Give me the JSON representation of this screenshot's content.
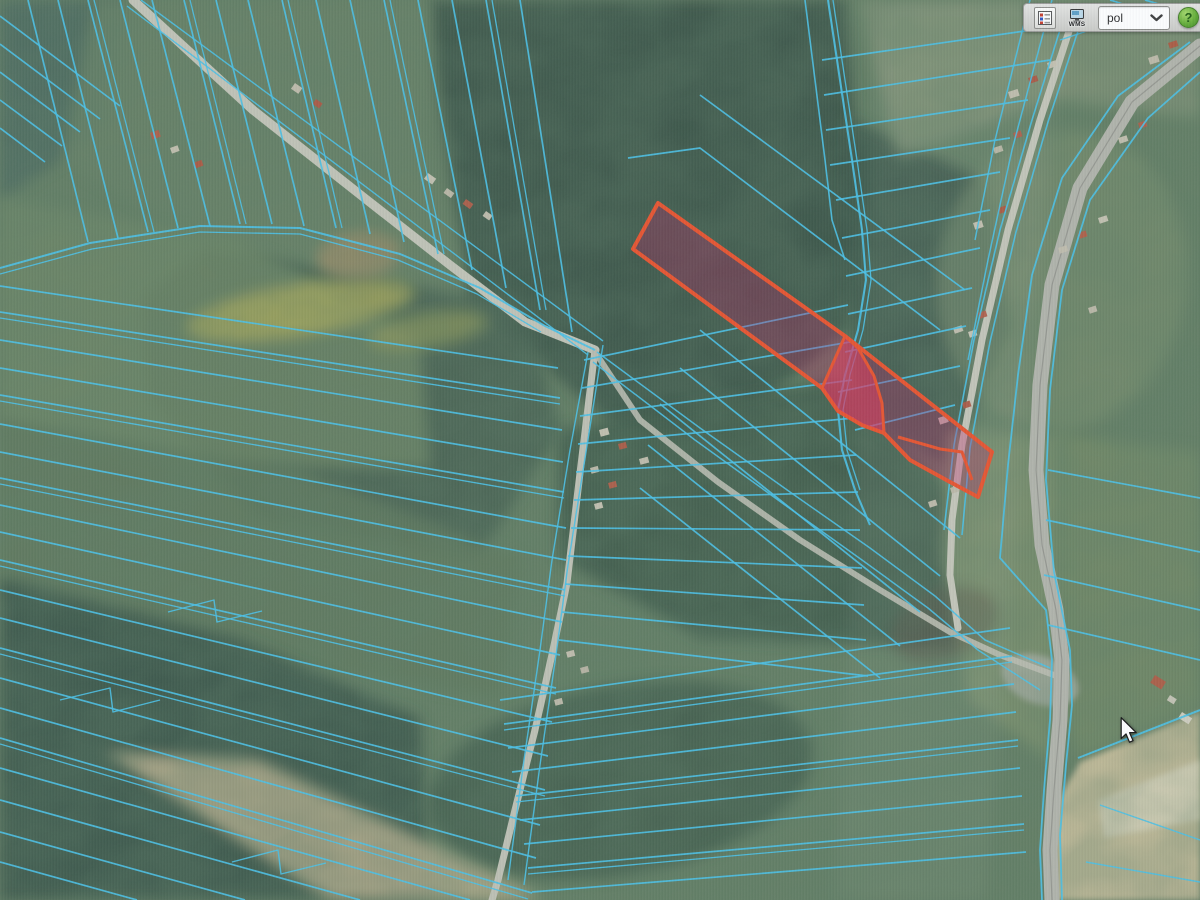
{
  "app": {
    "title": "gis-parcel-map-viewer"
  },
  "toolbar": {
    "wms_label": "WMS",
    "language_value": "pol",
    "help_label": "?",
    "legend_colors": [
      "#c43a2a",
      "#2a52c4"
    ]
  },
  "cursor": {
    "x": 1120,
    "y": 717
  },
  "map": {
    "colors": {
      "parcel": "#3fc4f0",
      "road": "#c5c6b8",
      "selection_stroke": "#f64b22",
      "selection_fill": "rgba(210,10,95,0.30)",
      "selection_bright_fill": "rgba(255,40,85,0.52)"
    },
    "patches": [
      {
        "p": "430,0 845,0 862,210 848,330 760,402 618,430 468,298 428,130",
        "f": "#2d483a",
        "o": 0.92
      },
      {
        "p": "205,248 520,290 560,430 478,558 258,518 148,398 142,298",
        "f": "#3a5744",
        "o": 0.85
      },
      {
        "p": "0,0 130,0 92,140 0,200",
        "f": "#416158",
        "o": 0.8
      },
      {
        "p": "95,0 428,0 468,298 205,240 62,160",
        "f": "#647e5e",
        "o": 0.85
      },
      {
        "p": "0,200 238,240 420,338 430,468 218,468 0,420",
        "f": "#6c855f",
        "o": 0.8
      },
      {
        "p": "0,420 298,468 520,558 500,698 238,658 0,598",
        "f": "#5a7455",
        "o": 0.85
      },
      {
        "p": "0,578 238,638 420,718 430,900 0,900",
        "f": "#2f4c3d",
        "o": 0.9
      },
      {
        "e": [
          620,
          780,
          195,
          95,
          -10
        ],
        "f": "#35523f",
        "o": 0.8
      },
      {
        "p": "558,430 840,378 980,518 958,648 700,638 558,558",
        "f": "#30503e",
        "o": 0.85
      },
      {
        "p": "848,118 982,178 1012,328 948,468 858,418 843,258",
        "f": "#2c473a",
        "o": 0.85
      },
      {
        "p": "948,430 1062,435 1056,700 1050,760 968,700 943,558",
        "f": "#7c9166",
        "o": 0.9
      },
      {
        "p": "1062,435 1200,452 1200,710 1078,758 1058,700",
        "f": "#6f875f",
        "o": 0.9
      },
      {
        "p": "858,0 1200,0 1200,118 1058,100 898,158",
        "f": "#8a9877",
        "o": 0.7
      },
      {
        "e": [
          1062,
          280,
          125,
          150,
          8
        ],
        "f": "#7d9169",
        "o": 0.55
      },
      {
        "e": [
          945,
          625,
          55,
          35,
          -20
        ],
        "f": "#503c30",
        "o": 0.45
      },
      {
        "p": "1080,762 1200,712 1200,900 1052,900 1058,800",
        "f": "#d9c79f",
        "o": 0.95,
        "fl": "soft2"
      },
      {
        "p": "1098,800 1200,760 1200,820 1104,838",
        "f": "#ece2c8",
        "o": 0.75,
        "fl": "soft2"
      },
      {
        "e": [
          300,
          310,
          115,
          26,
          -9
        ],
        "f": "#b5b04e",
        "o": 0.8
      },
      {
        "e": [
          428,
          330,
          60,
          17,
          -9
        ],
        "f": "#a8a64a",
        "o": 0.6
      },
      {
        "e": [
          358,
          255,
          42,
          23,
          -5
        ],
        "f": "#a08a60",
        "o": 0.9
      },
      {
        "p": "105,752 258,760 545,900 330,900",
        "f": "#c6b58d",
        "o": 0.85
      },
      {
        "e": [
          1040,
          680,
          40,
          24,
          20
        ],
        "f": "#b7b8ae",
        "o": 0.8,
        "fl": "soft2"
      },
      {
        "p": "880,0 1065,0 985,900 835,900",
        "f": "#ffffff",
        "o": 0.05
      }
    ],
    "roads": [
      {
        "p": "133,0 253,110 367,200 450,265 525,322 595,350",
        "w": 9
      },
      {
        "p": "595,350 580,473 567,583 553,650 535,730 515,810 498,880 492,900",
        "w": 7,
        "c": "#c2c3b5"
      },
      {
        "p": "595,352 640,420 718,482 800,540 880,590 950,632 1000,655 1062,678",
        "w": 6,
        "c": "#bdbeb0",
        "o": 0.9
      },
      {
        "p": "1072,22 1040,120 1008,230 982,340 962,445 952,520 950,575 958,628",
        "w": 7,
        "c": "#c8c8ba"
      },
      {
        "p": "1200,46 1132,102 1080,188 1052,285 1040,385 1036,470 1042,545 1056,610 1062,660 1060,720 1054,790 1050,850 1052,900",
        "w": 15,
        "c": "#b4b5ab"
      },
      {
        "p": "1200,46 1132,102 1080,188 1052,285 1040,385 1036,470 1042,545 1056,610 1062,660 1060,720 1054,790 1050,850 1052,900",
        "w": 1.2,
        "c": "#8f9088",
        "o": 0.8
      }
    ],
    "parcel_lines": [
      {
        "p": "0,16 120,106"
      },
      {
        "p": "0,44 100,119"
      },
      {
        "p": "0,72 80,132"
      },
      {
        "p": "0,100 62,146"
      },
      {
        "p": "0,128 45,162"
      },
      {
        "p": "28,0 88,242"
      },
      {
        "p": "58,0 118,238"
      },
      {
        "p": "88,0 148,232"
      },
      {
        "p": "94,0 154,232",
        "w": 1.3
      },
      {
        "p": "120,0 178,228"
      },
      {
        "p": "152,0 210,226"
      },
      {
        "p": "184,0 240,224"
      },
      {
        "p": "190,0 246,224",
        "w": 1.3
      },
      {
        "p": "216,0 272,224"
      },
      {
        "p": "248,0 304,226"
      },
      {
        "p": "282,0 336,228"
      },
      {
        "p": "288,0 342,228",
        "w": 1.3
      },
      {
        "p": "316,0 370,234"
      },
      {
        "p": "350,0 404,242"
      },
      {
        "p": "384,0 438,254"
      },
      {
        "p": "390,0 444,254",
        "w": 1.3
      },
      {
        "p": "418,0 472,270"
      },
      {
        "p": "452,0 506,288"
      },
      {
        "p": "486,0 540,310"
      },
      {
        "p": "492,0 546,310",
        "w": 1.3
      },
      {
        "p": "520,0 572,332"
      },
      {
        "p": "0,268 90,243 200,226 300,228 400,254 480,288 545,326 595,350",
        "w": 2
      },
      {
        "p": "0,274 92,249 200,232 300,234 398,260 477,294 541,332",
        "w": 1.3
      },
      {
        "p": "127,6 588,355",
        "w": 1.4
      },
      {
        "p": "141,0 603,341",
        "w": 1.4
      },
      {
        "p": "0,286 558,368"
      },
      {
        "p": "0,312 560,398"
      },
      {
        "p": "0,318 560,404",
        "w": 1.3
      },
      {
        "p": "0,340 562,430"
      },
      {
        "p": "0,368 563,462"
      },
      {
        "p": "0,395 564,492"
      },
      {
        "p": "0,401 564,498",
        "w": 1.3
      },
      {
        "p": "0,424 566,528"
      },
      {
        "p": "0,452 566,560"
      },
      {
        "p": "0,478 565,590"
      },
      {
        "p": "0,484 565,596",
        "w": 1.3
      },
      {
        "p": "0,505 562,622"
      },
      {
        "p": "0,532 560,655"
      },
      {
        "p": "0,560 556,688"
      },
      {
        "p": "0,566 556,694",
        "w": 1.3
      },
      {
        "p": "0,590 552,722"
      },
      {
        "p": "0,618 548,756"
      },
      {
        "p": "0,648 545,790"
      },
      {
        "p": "0,654 545,796",
        "w": 1.3
      },
      {
        "p": "0,678 540,825"
      },
      {
        "p": "0,708 536,858"
      },
      {
        "p": "0,738 532,893"
      },
      {
        "p": "0,744 528,899",
        "w": 1.3
      },
      {
        "p": "0,768 470,900"
      },
      {
        "p": "0,800 360,900"
      },
      {
        "p": "0,832 245,900"
      },
      {
        "p": "0,862 137,900"
      },
      {
        "p": "168,612 214,600 217,622 262,611",
        "w": 1.4
      },
      {
        "p": "60,700 110,688 113,712 160,700",
        "w": 1.4
      },
      {
        "p": "232,862 278,850 281,874 326,863",
        "w": 1.4
      },
      {
        "p": "584,360 848,305"
      },
      {
        "p": "582,388 850,342"
      },
      {
        "p": "580,416 852,380"
      },
      {
        "p": "578,444 854,418"
      },
      {
        "p": "576,472 856,455"
      },
      {
        "p": "574,500 858,492"
      },
      {
        "p": "571,528 860,530"
      },
      {
        "p": "568,556 862,568"
      },
      {
        "p": "565,584 864,605"
      },
      {
        "p": "562,612 866,640"
      },
      {
        "p": "559,640 868,676"
      },
      {
        "p": "700,330 960,538"
      },
      {
        "p": "680,368 940,576"
      },
      {
        "p": "660,404 920,612"
      },
      {
        "p": "648,445 900,646"
      },
      {
        "p": "640,488 880,678"
      },
      {
        "p": "628,158 700,148 940,330"
      },
      {
        "p": "700,95 965,290"
      },
      {
        "p": "828,0 840,80 852,160 862,230 866,280 858,330 845,375 838,410 842,450 855,490 870,525",
        "w": 2.1
      },
      {
        "p": "833,0 845,80 857,160 867,230 871,280 863,330 850,375 843,410 847,450 860,490",
        "w": 1.3
      },
      {
        "p": "805,0 815,80 825,160 832,220 845,260",
        "w": 1.6
      },
      {
        "p": "822,60 1046,28"
      },
      {
        "p": "824,95 1050,60"
      },
      {
        "p": "826,130 1028,100"
      },
      {
        "p": "830,165 1010,138"
      },
      {
        "p": "836,200 1000,172"
      },
      {
        "p": "842,238 990,210"
      },
      {
        "p": "846,276 980,248"
      },
      {
        "p": "848,314 972,288"
      },
      {
        "p": "845,352 966,326"
      },
      {
        "p": "838,392 960,366"
      },
      {
        "p": "855,430 955,405"
      },
      {
        "p": "1052,0 1012,150 988,260 968,360",
        "w": 1.5
      },
      {
        "p": "1030,0 995,140 975,240",
        "w": 1.5
      },
      {
        "p": "1063,20 1032,120 1000,230 974,340 954,445 944,530",
        "w": 1.6
      },
      {
        "p": "1080,25 1048,122 1016,232 990,342 970,448 962,535",
        "w": 1.6
      },
      {
        "p": "1110,0 1200,28"
      },
      {
        "p": "1145,0 1200,16"
      },
      {
        "p": "1060,40 1120,20",
        "w": 1.4
      },
      {
        "p": "1190,42 1118,96 1062,178 1032,275 1018,375 1008,465 1000,558 1046,610 1052,660 1050,720 1044,790 1040,850 1042,900",
        "w": 1.8
      },
      {
        "p": "1200,72 1148,118 1090,200 1062,290 1050,390 1046,480 1054,572 1070,650 1072,705 1066,765 1060,835 1062,900",
        "w": 1.8
      },
      {
        "p": "597,352 700,428 790,492 870,548 935,596 985,640 1050,668",
        "w": 1.5
      },
      {
        "p": "593,362 695,440 785,505 862,560 928,608 978,650 1040,690",
        "w": 1.5
      },
      {
        "p": "500,700 1010,628"
      },
      {
        "p": "504,724 1012,656"
      },
      {
        "p": "504,730 1012,662",
        "w": 1.3
      },
      {
        "p": "508,748 1014,684"
      },
      {
        "p": "512,772 1016,712"
      },
      {
        "p": "516,796 1018,740"
      },
      {
        "p": "516,802 1018,746",
        "w": 1.3
      },
      {
        "p": "520,820 1020,768"
      },
      {
        "p": "524,844 1022,796"
      },
      {
        "p": "528,868 1024,824"
      },
      {
        "p": "528,874 1024,830",
        "w": 1.3
      },
      {
        "p": "532,892 1026,852"
      },
      {
        "p": "588,352 570,450 552,560 540,650 524,760 508,880",
        "w": 1.4
      },
      {
        "p": "603,345 586,452 568,565 556,655 540,765 524,885",
        "w": 1.4
      },
      {
        "p": "1048,470 1200,498"
      },
      {
        "p": "1046,520 1200,552"
      },
      {
        "p": "1044,575 1200,610"
      },
      {
        "p": "1048,625 1200,660"
      },
      {
        "p": "1078,758 1200,710",
        "w": 2
      },
      {
        "p": "1100,805 1200,840",
        "w": 1.4
      },
      {
        "p": "1086,862 1200,882",
        "w": 1.4
      }
    ],
    "selection": {
      "main": "658,203 845,336 992,452 978,497 950,482 910,460 884,433 862,425 838,411 822,388 633,249",
      "bright": "845,336 858,348 874,376 882,403 884,433 862,425 838,411 822,388",
      "inner_line": "898,437 940,449 962,452 972,480"
    },
    "houses": [
      [
        150,
        133,
        9,
        7,
        -20,
        "#b8573d"
      ],
      [
        170,
        148,
        8,
        6,
        -20,
        "#c9c3b0"
      ],
      [
        193,
        163,
        9,
        6,
        -20,
        "#b45138"
      ],
      [
        295,
        83,
        9,
        7,
        35,
        "#c6c0ae"
      ],
      [
        316,
        99,
        8,
        6,
        35,
        "#b2503a"
      ],
      [
        428,
        173,
        10,
        7,
        35,
        "#ccc6b4"
      ],
      [
        447,
        188,
        9,
        6,
        35,
        "#c2bcaa"
      ],
      [
        466,
        199,
        9,
        6,
        35,
        "#b65740"
      ],
      [
        486,
        211,
        8,
        6,
        35,
        "#c8c2b0"
      ],
      [
        599,
        430,
        9,
        7,
        -15,
        "#cdc7b5"
      ],
      [
        618,
        444,
        8,
        6,
        -15,
        "#b5543c"
      ],
      [
        639,
        459,
        9,
        6,
        -15,
        "#c9c3b1"
      ],
      [
        590,
        468,
        8,
        6,
        -15,
        "#c4beac"
      ],
      [
        608,
        483,
        8,
        6,
        -15,
        "#b8573f"
      ],
      [
        594,
        504,
        8,
        6,
        -15,
        "#ccc6b4"
      ],
      [
        566,
        652,
        8,
        6,
        -15,
        "#c8c2b0"
      ],
      [
        580,
        668,
        8,
        6,
        -15,
        "#bdb7a5"
      ],
      [
        554,
        700,
        8,
        6,
        -15,
        "#c4beac"
      ],
      [
        1008,
        92,
        10,
        7,
        -18,
        "#c8c2b0"
      ],
      [
        1028,
        78,
        9,
        6,
        -18,
        "#b2503a"
      ],
      [
        1047,
        63,
        9,
        6,
        -18,
        "#ccc6b4"
      ],
      [
        993,
        148,
        9,
        6,
        -18,
        "#c0baa8"
      ],
      [
        1013,
        133,
        8,
        6,
        -18,
        "#b65740"
      ],
      [
        973,
        223,
        9,
        7,
        -18,
        "#cbc5b3"
      ],
      [
        998,
        208,
        8,
        6,
        -18,
        "#b45138"
      ],
      [
        1058,
        248,
        9,
        6,
        -18,
        "#c6c0ae"
      ],
      [
        1078,
        233,
        8,
        6,
        -18,
        "#b8573d"
      ],
      [
        953,
        328,
        9,
        6,
        -18,
        "#c9c3b1"
      ],
      [
        978,
        313,
        8,
        6,
        -18,
        "#b55740"
      ],
      [
        968,
        332,
        8,
        6,
        -18,
        "#d0cab8"
      ],
      [
        938,
        418,
        9,
        7,
        -18,
        "#ccc6b4"
      ],
      [
        962,
        403,
        8,
        6,
        -18,
        "#b2503a"
      ],
      [
        928,
        502,
        8,
        6,
        -18,
        "#c6c0ae"
      ],
      [
        950,
        488,
        8,
        6,
        -18,
        "#c0baa8"
      ],
      [
        1148,
        58,
        10,
        7,
        -18,
        "#c4beac"
      ],
      [
        1168,
        43,
        9,
        6,
        -18,
        "#b45138"
      ],
      [
        1118,
        138,
        9,
        6,
        -18,
        "#c9c3b1"
      ],
      [
        1138,
        123,
        8,
        6,
        -18,
        "#b65740"
      ],
      [
        1098,
        218,
        9,
        6,
        -18,
        "#ccc6b4"
      ],
      [
        1088,
        308,
        8,
        6,
        -18,
        "#c2bcaa"
      ],
      [
        1155,
        675,
        13,
        9,
        32,
        "#b5543c"
      ],
      [
        1182,
        712,
        12,
        7,
        32,
        "#d8d4c4"
      ],
      [
        1170,
        695,
        8,
        6,
        32,
        "#ccc8b8"
      ]
    ]
  }
}
